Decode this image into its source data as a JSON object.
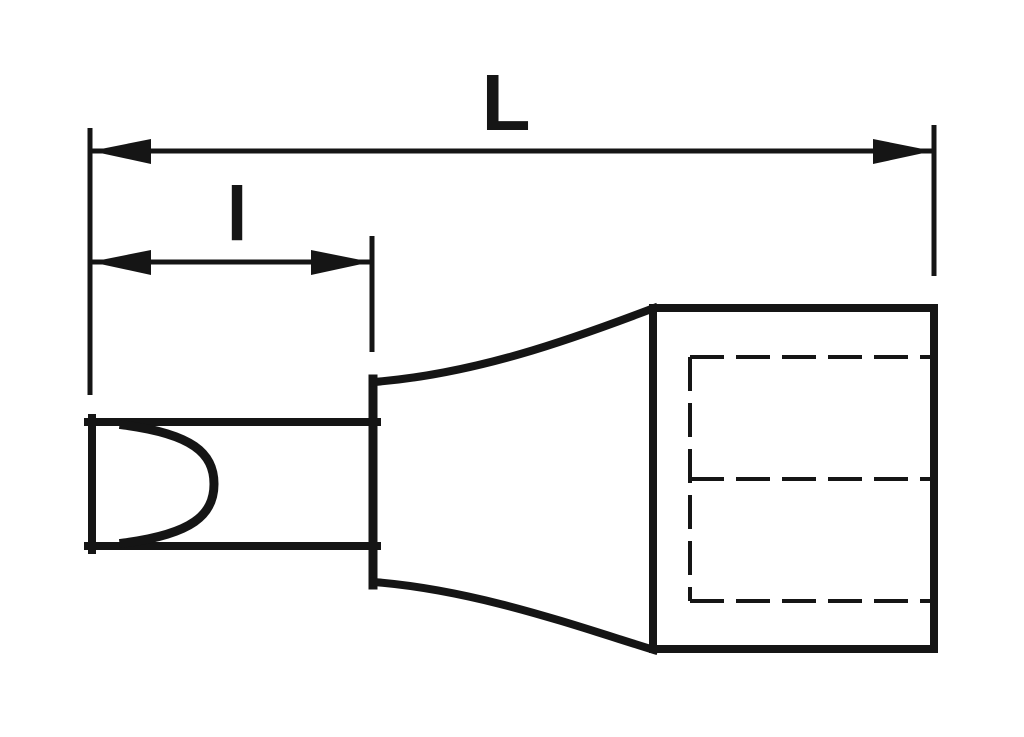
{
  "diagram": {
    "labels": {
      "overall_length": "L",
      "tip_length": "l"
    },
    "colors": {
      "ink": "#151515",
      "paper": "#ffffff"
    }
  }
}
